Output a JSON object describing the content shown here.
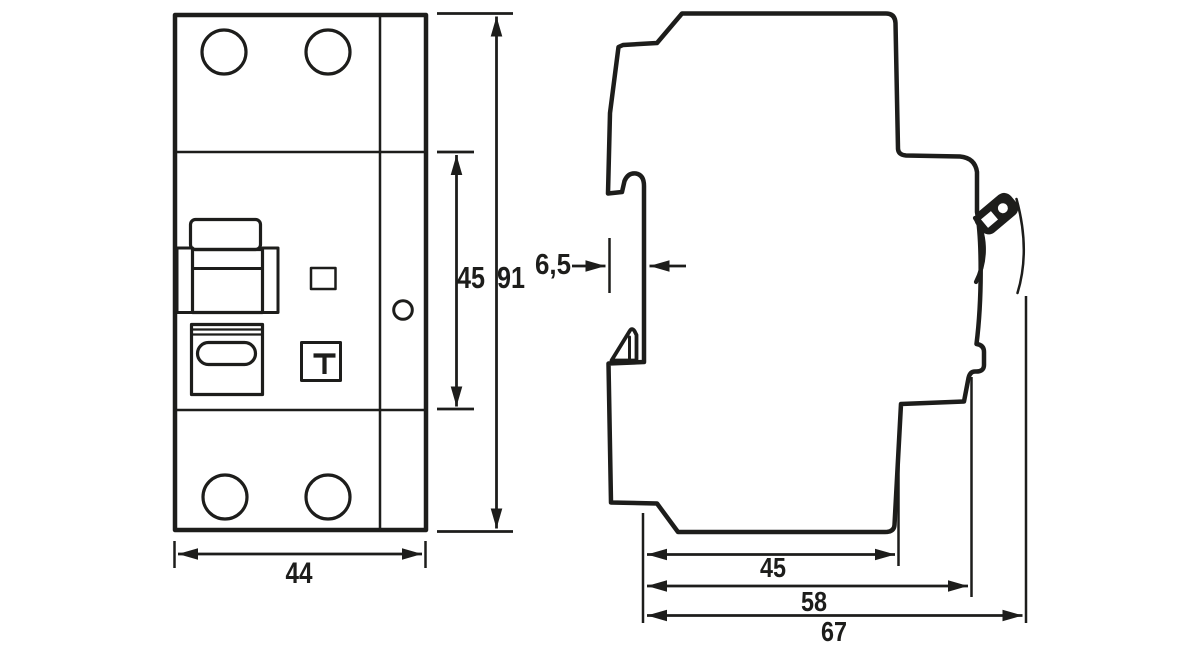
{
  "diagram": {
    "front_view": {
      "width": "44",
      "module_height": "45",
      "total_height": "91"
    },
    "side_view": {
      "rail_recess_depth": "6,5",
      "body_depth": "45",
      "depth_incl_clip": "58",
      "overall_depth": "67"
    },
    "colors": {
      "line": "#1d1d1b",
      "background": "#ffffff"
    }
  }
}
